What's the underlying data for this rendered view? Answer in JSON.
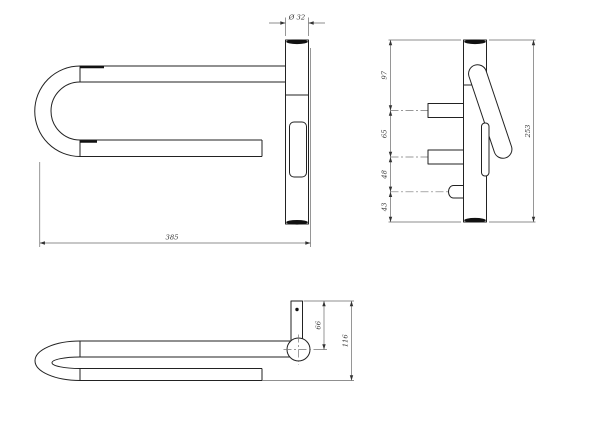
{
  "front_view": {
    "diameter_label": "Ø 32",
    "length_label": "385"
  },
  "side_view": {
    "seg1_label": "97",
    "seg2_label": "65",
    "seg3_label": "48",
    "seg4_label": "43",
    "height_label": "253"
  },
  "bottom_view": {
    "offset_label": "66",
    "depth_label": "116"
  },
  "colors": {
    "background": "#ffffff",
    "geometry_line": "#222222",
    "dimension_line": "#6a6a6a",
    "dimension_text": "#333333"
  }
}
